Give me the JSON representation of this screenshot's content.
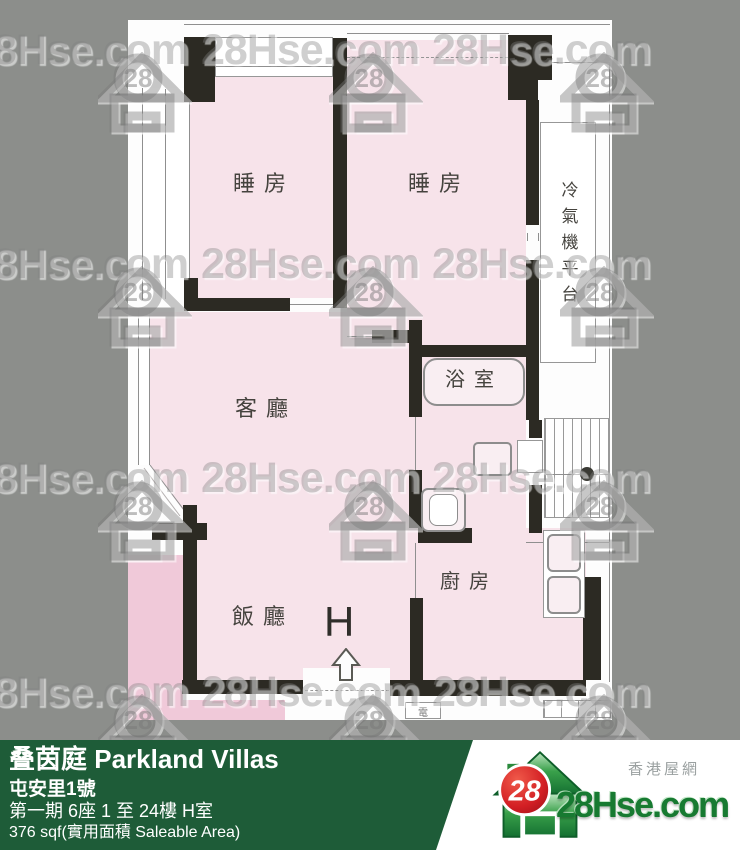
{
  "watermark": {
    "text": "28Hse.com",
    "badge": "28"
  },
  "plan": {
    "labels": {
      "bedroom1": "睡房",
      "bedroom2": "睡房",
      "living_room": "客廳",
      "dining_room": "飯廳",
      "kitchen": "廚房",
      "bathroom": "浴室",
      "ac_platform": "冷氣機平台",
      "unit_marker": "H",
      "electric_meter": "電"
    }
  },
  "info_bar": {
    "title": "叠茵庭 Parkland Villas",
    "address": "屯安里1號",
    "block_floor_unit": "第一期 6座 1 至 24樓 H室",
    "area": "376 sqf(實用面積 Saleable Area)"
  },
  "logo": {
    "badge": "28",
    "site_name": "28Hse.com",
    "site_name_cn": "香港屋網"
  },
  "colors": {
    "background_gray": "#8c8e8b",
    "paper_white": "#fdfdfd",
    "room_pink": "#f7e3ea",
    "adjacent_pink": "#f0c9d9",
    "wall_black": "#2c2a23",
    "bar_green": "#1e5c38",
    "logo_green": "#2e9140",
    "logo_red": "#cf1f24",
    "logo_text_green": "#177a31"
  }
}
